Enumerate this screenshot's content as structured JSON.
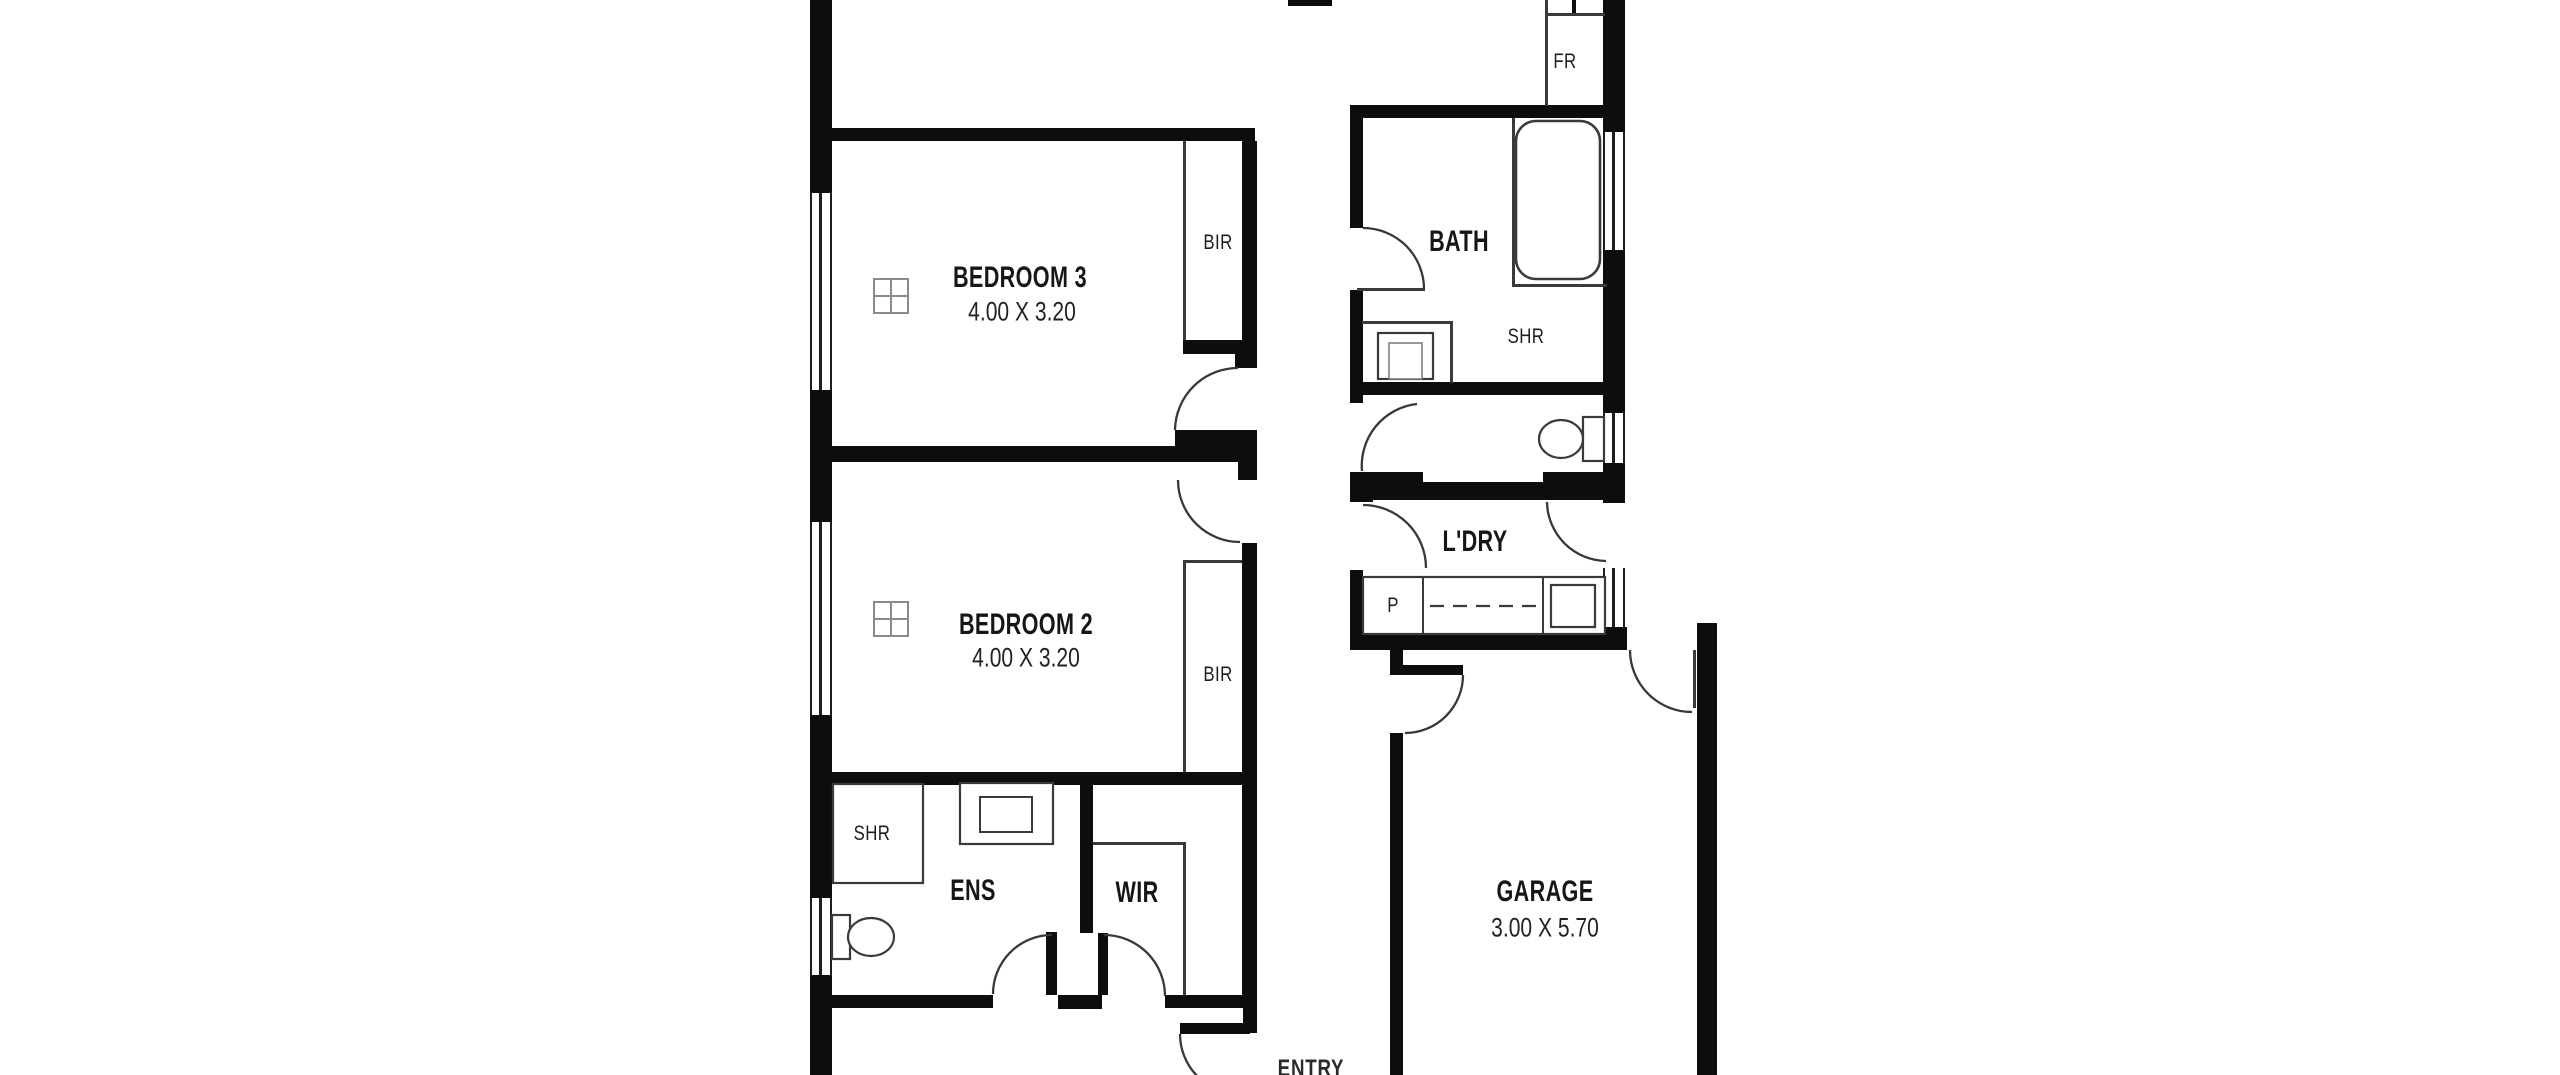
{
  "colors": {
    "background": "#ffffff",
    "walls": "#0d0d0d",
    "fixture_lines": "#3a3a3a",
    "door_arcs": "#383838",
    "window_lines": "#1d1d1d",
    "label_text": "#161616"
  },
  "rooms": {
    "bedroom3": {
      "name": "BEDROOM 3",
      "dims": "4.00 X 3.20"
    },
    "bedroom2": {
      "name": "BEDROOM 2",
      "dims": "4.00 X 3.20"
    },
    "garage": {
      "name": "GARAGE",
      "dims": "3.00 X 5.70"
    },
    "bath": {
      "name": "BATH"
    },
    "laundry": {
      "name": "L'DRY"
    },
    "ensuite": {
      "name": "ENS"
    },
    "wir": {
      "name": "WIR"
    },
    "entry": {
      "name": "ENTRY"
    }
  },
  "fixtures": {
    "bir_bedroom3": "BIR",
    "bir_bedroom2": "BIR",
    "fridge": "FR",
    "shower_bath": "SHR",
    "shower_ensuite": "SHR",
    "pantry": "P"
  }
}
